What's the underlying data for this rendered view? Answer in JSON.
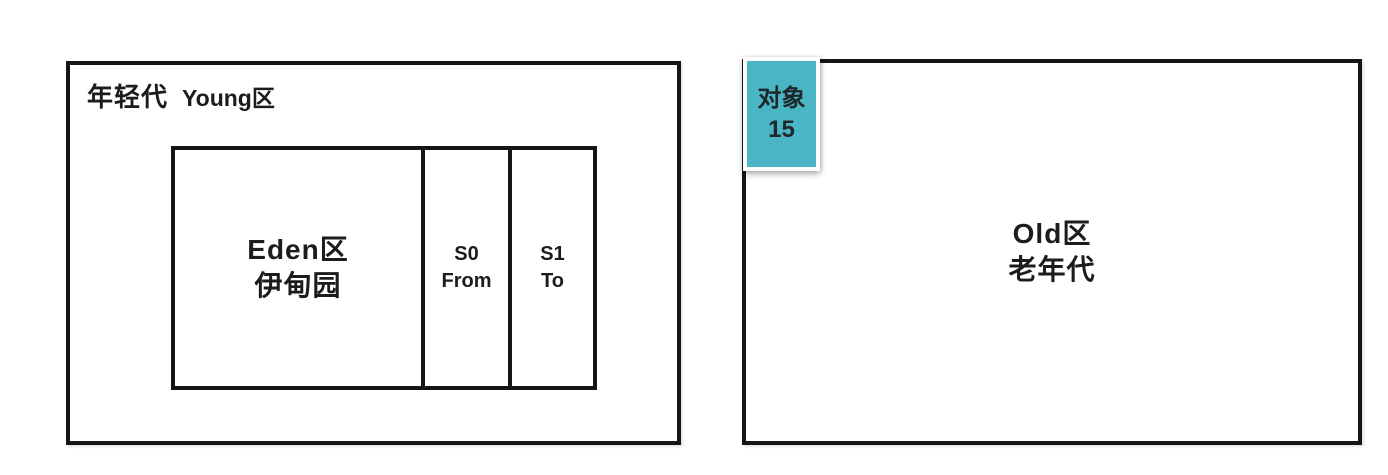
{
  "diagram": {
    "young": {
      "title_cn": "年轻代",
      "title_en": "Young区",
      "eden": {
        "line1": "Eden区",
        "line2": "伊甸园"
      },
      "s0": {
        "line1": "S0",
        "line2": "From"
      },
      "s1": {
        "line1": "S1",
        "line2": "To"
      }
    },
    "old": {
      "line1": "Old区",
      "line2": "老年代"
    },
    "badge": {
      "line1": "对象",
      "line2": "15"
    },
    "colors": {
      "border": "#151515",
      "text": "#1c1c1c",
      "badge_fill": "#4ab5c4",
      "badge_frame": "#ffffff",
      "background": "#ffffff"
    }
  }
}
